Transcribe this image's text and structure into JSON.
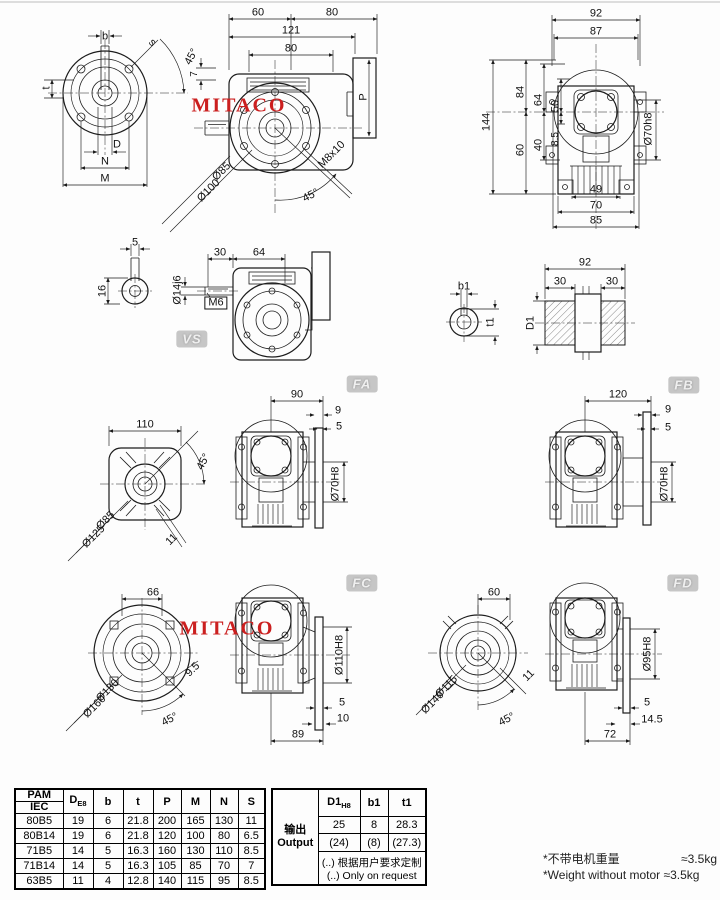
{
  "drawing": {
    "watermark": "MITACO",
    "watermark_color": "#cb1f1f",
    "badges": {
      "vs": "VS",
      "fa": "FA",
      "fb": "FB",
      "fc": "FC",
      "fd": "FD"
    }
  },
  "views": {
    "v1": {
      "b": "b",
      "s": "s",
      "angle": "45°",
      "t": "t",
      "d": "D",
      "n": "N",
      "m": "M"
    },
    "v2": {
      "w60": "60",
      "w80": "80",
      "w121": "121",
      "w80b": "80",
      "k7": "7",
      "p": "P",
      "tap": "M8x10",
      "dia85": "Ø85",
      "dia100": "Ø100",
      "angle": "45°"
    },
    "v3": {
      "w92": "92",
      "w87": "87",
      "h144": "144",
      "h84": "84",
      "h64": "64",
      "h50": "50",
      "h60": "60",
      "h40": "40",
      "h85": "8.5",
      "bore": "Ø70h8",
      "w49": "49",
      "w70": "70",
      "w85": "85"
    },
    "vs": {
      "k5": "5",
      "k16": "16",
      "w30": "30",
      "w64": "64",
      "shaft": "Ø14j6",
      "tap": "M6"
    },
    "out": {
      "b1": "b1",
      "t1": "t1",
      "w92": "92",
      "w30a": "30",
      "w30b": "30",
      "d1": "D1"
    },
    "fa": {
      "w110": "110",
      "angle": "45°",
      "dia85": "Ø85",
      "dia125": "Ø125",
      "s11": "11",
      "w90": "90",
      "t9": "9",
      "t5": "5",
      "bore": "Ø70H8"
    },
    "fb": {
      "w120": "120",
      "t9": "9",
      "t5": "5",
      "bore": "Ø70H8"
    },
    "fc": {
      "w66": "66",
      "dia130": "Ø130",
      "dia160": "Ø160",
      "s95": "9.5",
      "angle": "45°",
      "bore": "Ø110H8",
      "t5": "5",
      "t10": "10",
      "w89": "89"
    },
    "fd": {
      "w60": "60",
      "dia115": "Ø115",
      "dia140": "Ø140",
      "s11": "11",
      "angle": "45°",
      "bore": "Ø95H8",
      "t5": "5",
      "t145": "14.5",
      "w72": "72"
    }
  },
  "table": {
    "header": {
      "pam": "PAM",
      "iec": "IEC",
      "d": "D",
      "d_sub": "E8",
      "b": "b",
      "t": "t",
      "p": "P",
      "m": "M",
      "n": "N",
      "s": "S"
    },
    "rows": [
      {
        "model": "80B5",
        "d": "19",
        "b": "6",
        "t": "21.8",
        "p": "200",
        "m": "165",
        "n": "130",
        "s": "11"
      },
      {
        "model": "80B14",
        "d": "19",
        "b": "6",
        "t": "21.8",
        "p": "120",
        "m": "100",
        "n": "80",
        "s": "6.5"
      },
      {
        "model": "71B5",
        "d": "14",
        "b": "5",
        "t": "16.3",
        "p": "160",
        "m": "130",
        "n": "110",
        "s": "8.5"
      },
      {
        "model": "71B14",
        "d": "14",
        "b": "5",
        "t": "16.3",
        "p": "105",
        "m": "85",
        "n": "70",
        "s": "7"
      },
      {
        "model": "63B5",
        "d": "11",
        "b": "4",
        "t": "12.8",
        "p": "140",
        "m": "115",
        "n": "95",
        "s": "8.5"
      }
    ],
    "output": {
      "label_cn": "输出",
      "label_en": "Output",
      "d1": "D1",
      "d1_sub": "H8",
      "b1": "b1",
      "t1": "t1",
      "rows": [
        {
          "d1": "25",
          "b1": "8",
          "t1": "28.3"
        },
        {
          "d1": "(24)",
          "b1": "(8)",
          "t1": "(27.3)"
        }
      ],
      "note_cn": "(..) 根据用户要求定制",
      "note_en": "(..) Only on request"
    }
  },
  "notes": {
    "weight_cn_label": "*不带电机重量",
    "weight_cn_value": "≈3.5kg",
    "weight_en": "*Weight without motor ≈3.5kg"
  }
}
